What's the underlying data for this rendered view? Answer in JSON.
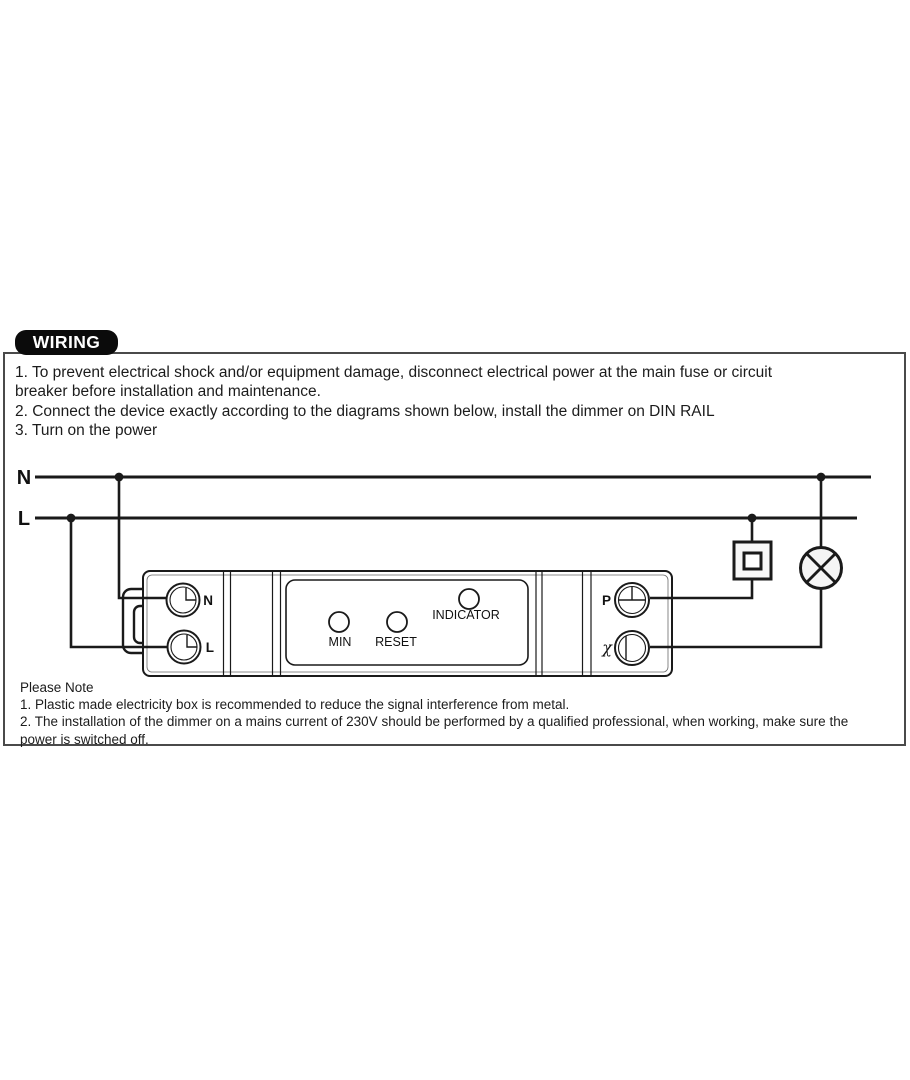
{
  "header": {
    "badge_label": "WIRING"
  },
  "instructions": {
    "lines": [
      "1. To prevent electrical shock and/or equipment damage, disconnect electrical power at the main fuse or circuit",
      "breaker before installation and maintenance.",
      "2. Connect the device exactly according to the diagrams shown below, install the dimmer on DIN RAIL",
      "3. Turn on the power"
    ]
  },
  "diagram": {
    "bus_labels": {
      "neutral": "N",
      "live": "L"
    },
    "device": {
      "terminal_n": "N",
      "terminal_l": "L",
      "terminal_p": "P",
      "terminal_load": "χ",
      "button_min": "MIN",
      "button_reset": "RESET",
      "indicator_label": "INDICATOR"
    },
    "symbols": {
      "switch": "wall-switch",
      "lamp": "lamp"
    },
    "colors": {
      "wire": "#1a1a1a",
      "device_outline": "#1a1a1a",
      "box_border": "#4a4a4a",
      "badge_bg": "#0b0b0b",
      "badge_text": "#ffffff",
      "symbol_fill": "#f5f5f5"
    }
  },
  "notes": {
    "title": "Please Note",
    "lines": [
      "1. Plastic made electricity box is recommended to reduce the signal interference from metal.",
      "2. The installation of the dimmer on a mains current of 230V should be performed by a qualified professional, when working, make sure the",
      "power is switched off."
    ]
  }
}
